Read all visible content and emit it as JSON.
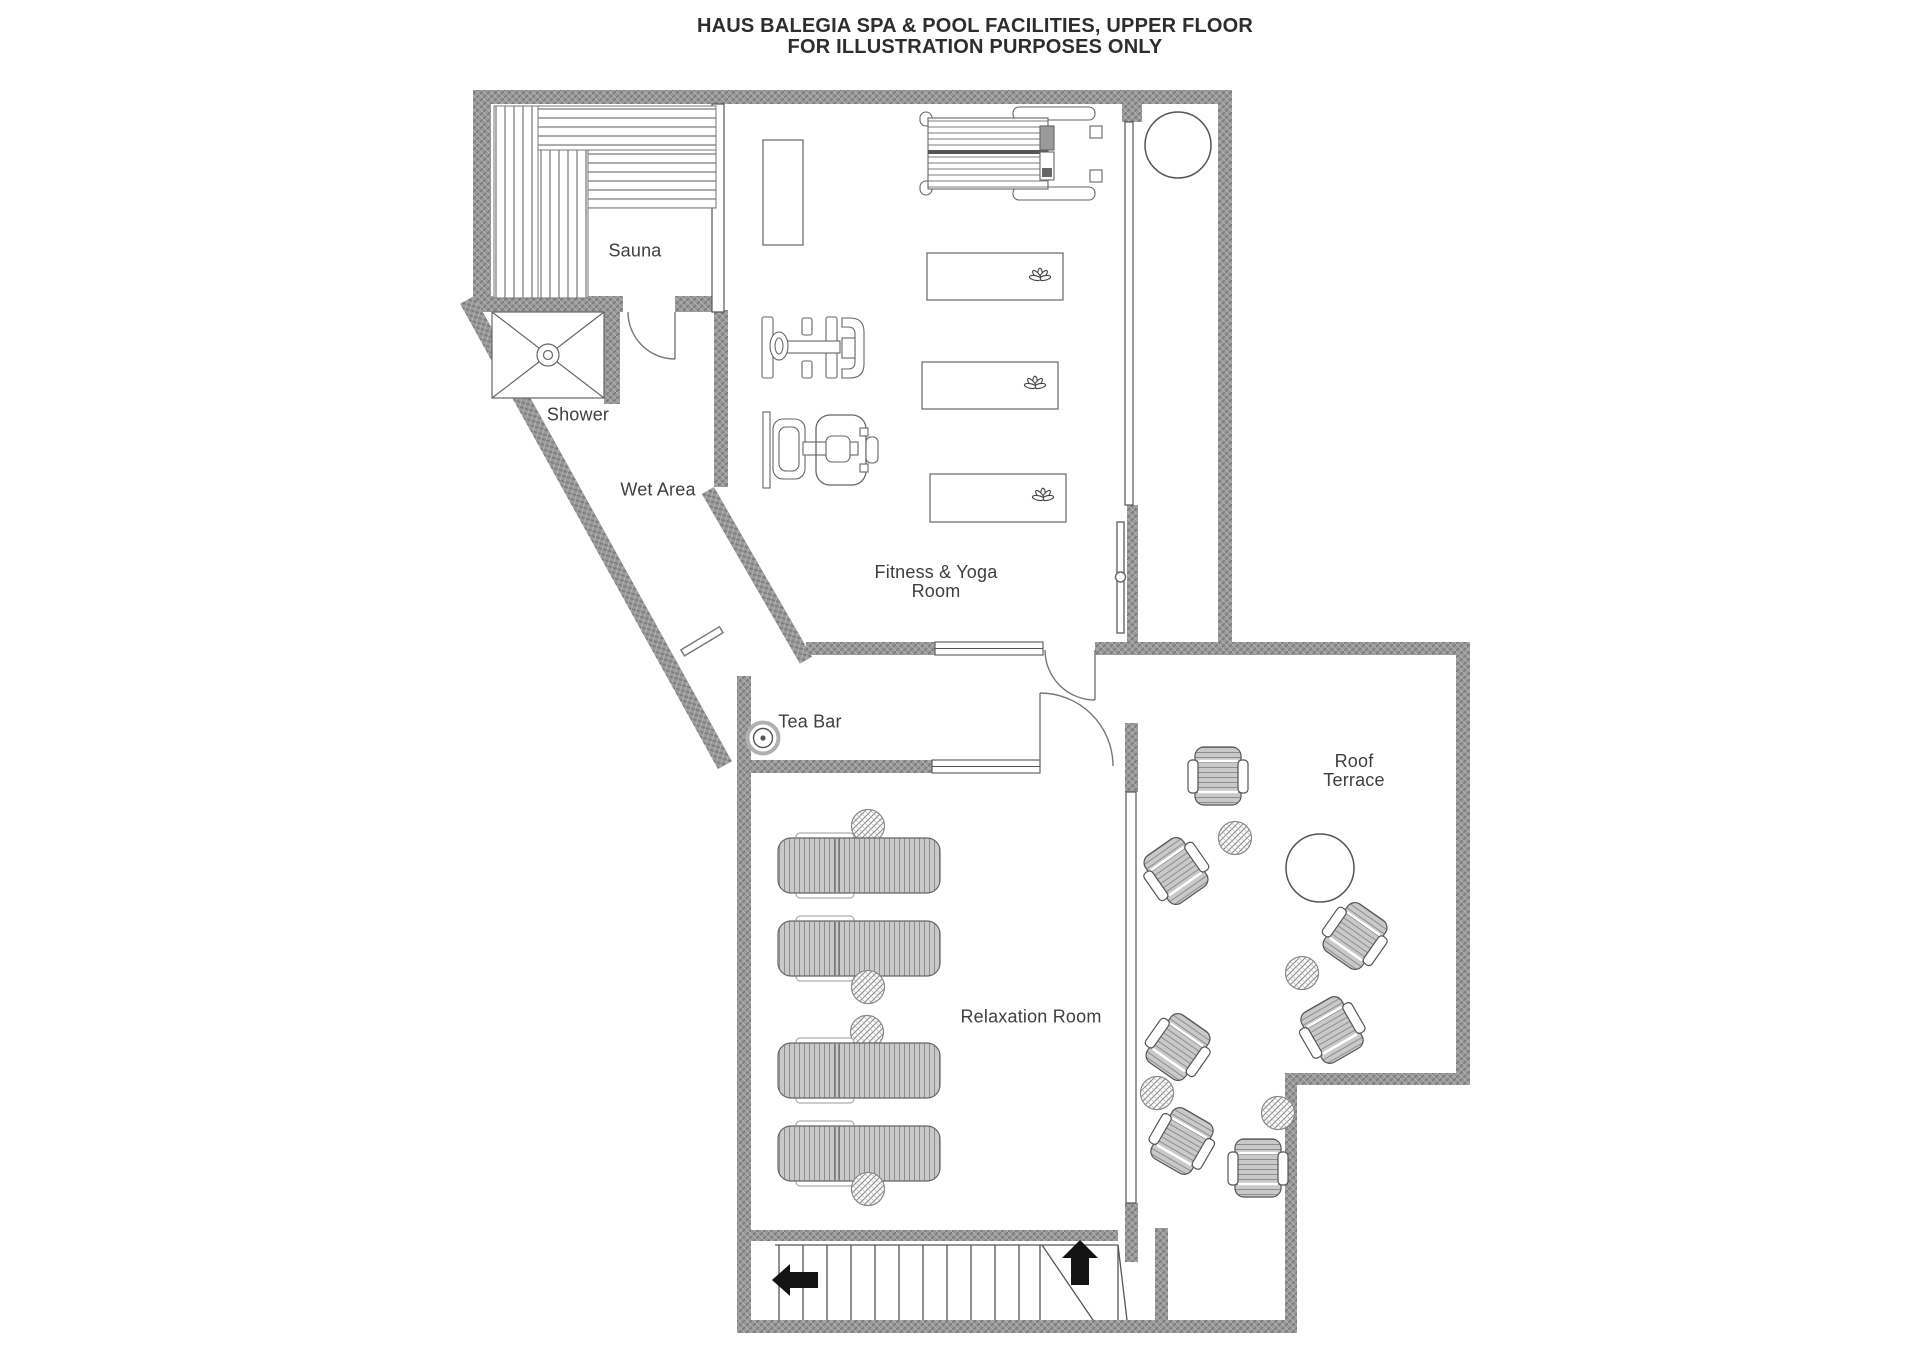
{
  "title": "HAUS BALEGIA SPA & POOL FACILITIES, UPPER FLOOR\nFOR ILLUSTRATION PURPOSES ONLY",
  "rooms": {
    "sauna": "Sauna",
    "shower": "Shower",
    "wet_area": "Wet Area",
    "fitness": "Fitness & Yoga\nRoom",
    "tea_bar": "Tea Bar",
    "relaxation": "Relaxation Room",
    "roof_terrace": "Roof\nTerrace"
  },
  "icons": {
    "yoga_mat_marker": "lotus-icon",
    "shower_drain": "drain-icon",
    "stair_direction_down": "arrow-left-icon",
    "stair_direction_up": "arrow-up-icon",
    "tea_bar_stool": "stool-icon"
  },
  "colors": {
    "wall_fill": "#999999",
    "wall_hatch_dark": "#7b7b7b",
    "wall_hatch_light": "#b3b3b3",
    "outline": "#666666",
    "upholstery_fill": "#c9c9c9",
    "text": "#3e3e3e",
    "arrow": "#141414",
    "background": "#ffffff"
  },
  "furniture": {
    "sun_loungers": 4,
    "lounger_side_tables": 4,
    "terrace_armchairs": 7,
    "terrace_small_tables": 4,
    "terrace_round_tables": 2,
    "yoga_mats": 3,
    "gym_machines": 3,
    "sauna_benches": 4
  }
}
